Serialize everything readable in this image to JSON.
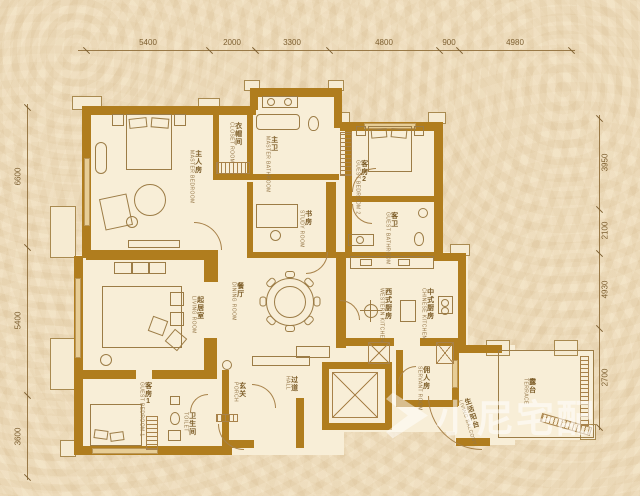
{
  "plan_title": "residential floor plan",
  "colors": {
    "wall": "#b07d1e",
    "line": "#9a7a48",
    "background": "#f1e0c1",
    "floor": "#f8eed7",
    "label_text": "#7c5c27",
    "watermark": "rgba(255,255,255,0.55)"
  },
  "dimensions": {
    "top": [
      "5400",
      "2000",
      "3300",
      "4800",
      "900",
      "4980"
    ],
    "left": [
      "6600",
      "5400",
      "3600"
    ],
    "right": [
      "3950",
      "2100",
      "4930",
      "2700"
    ]
  },
  "rooms": [
    {
      "id": "master-bedroom",
      "zh": "主人房",
      "en": "MASTER BEDROOM"
    },
    {
      "id": "closet-room",
      "zh": "衣帽间",
      "en": "CLOSET ROOM"
    },
    {
      "id": "master-bathroom",
      "zh": "主卫",
      "en": "MASTER BATHROOM"
    },
    {
      "id": "study-room",
      "zh": "书房",
      "en": "STUDY ROOM"
    },
    {
      "id": "guest-bedroom-2",
      "zh": "客房2",
      "en": "GUEST BEDROOM 2"
    },
    {
      "id": "guest-bathroom",
      "zh": "客卫",
      "en": "GUEST BATHROOM"
    },
    {
      "id": "living-room",
      "zh": "起居室",
      "en": "LIVING ROOM"
    },
    {
      "id": "dining-room",
      "zh": "餐厅",
      "en": "DINING ROOM"
    },
    {
      "id": "guest-bedroom-1",
      "zh": "客房1",
      "en": "GUEST BEDROOM 1"
    },
    {
      "id": "toilet",
      "zh": "卫生间",
      "en": "TOILET"
    },
    {
      "id": "porch",
      "zh": "玄关",
      "en": "PORCH"
    },
    {
      "id": "hall",
      "zh": "过道",
      "en": "HALL"
    },
    {
      "id": "western-kitchen",
      "zh": "西式厨房",
      "en": "WESTERN KITCHEN"
    },
    {
      "id": "chinese-kitchen",
      "zh": "中式厨房",
      "en": "CHINESE KITCHEN"
    },
    {
      "id": "servant-room",
      "zh": "佣人房",
      "en": "SERVANT ROOM"
    },
    {
      "id": "terrace",
      "zh": "露台",
      "en": "TERRACE"
    },
    {
      "id": "living-balcony",
      "zh": "生活阳台",
      "en": "LIVING BALCONY"
    }
  ],
  "watermark": {
    "text": "小尼宅配",
    "icon": "play-triangle-logo"
  }
}
